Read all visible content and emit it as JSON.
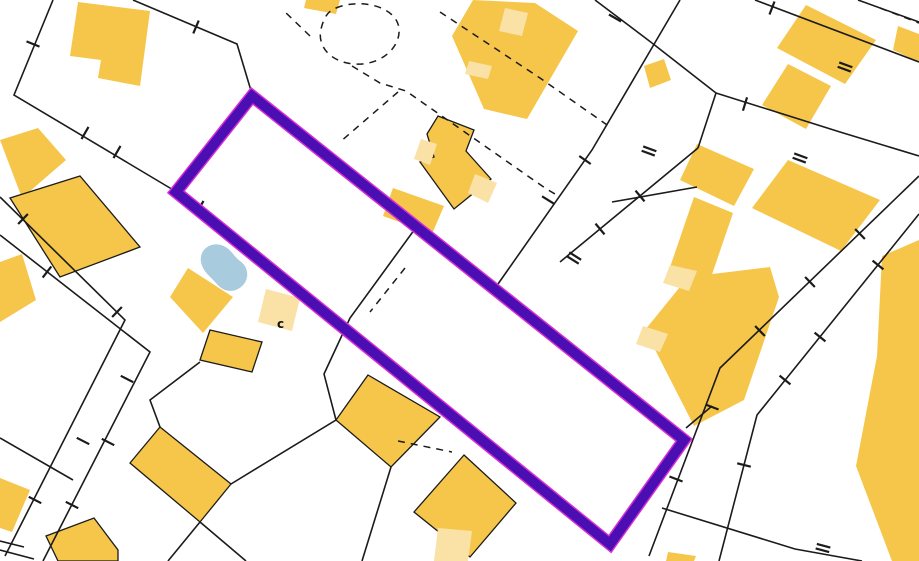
{
  "canvas": {
    "width": 919,
    "height": 561,
    "background": "#ffffff"
  },
  "palette": {
    "building": "#F6C64A",
    "building_light": "#FAE2A6",
    "water": "#A9CBDE",
    "line": "#1b1b1b",
    "highlight": "#4A0EB2",
    "highlight_fringe": "#D62FD4"
  },
  "annotation": {
    "text": "c"
  },
  "highlight_parcel": {
    "points": [
      [
        252,
        96
      ],
      [
        684,
        440
      ],
      [
        610,
        544
      ],
      [
        176,
        192
      ]
    ],
    "stroke_width": 10,
    "fringe_width": 13
  },
  "water_body": {
    "path": "M201,262 C199,250 210,242 221,245 C231,248 233,256 240,261 C249,267 250,280 241,287 C232,294 222,291 216,283 C210,276 203,272 201,262 Z"
  },
  "buildings": [
    {
      "points": [
        [
          78,
          2
        ],
        [
          150,
          11
        ],
        [
          140,
          86
        ],
        [
          98,
          78
        ],
        [
          101,
          60
        ],
        [
          70,
          56
        ]
      ],
      "fill": "building",
      "outlined": false
    },
    {
      "points": [
        [
          0,
          140
        ],
        [
          38,
          128
        ],
        [
          66,
          160
        ],
        [
          22,
          198
        ]
      ],
      "fill": "building",
      "outlined": false
    },
    {
      "points": [
        [
          10,
          198
        ],
        [
          80,
          176
        ],
        [
          140,
          247
        ],
        [
          60,
          277
        ]
      ],
      "fill": "building",
      "outlined": true
    },
    {
      "points": [
        [
          0,
          262
        ],
        [
          22,
          254
        ],
        [
          36,
          300
        ],
        [
          0,
          322
        ]
      ],
      "fill": "building",
      "outlined": false
    },
    {
      "points": [
        [
          0,
          478
        ],
        [
          30,
          490
        ],
        [
          12,
          532
        ],
        [
          0,
          528
        ]
      ],
      "fill": "building",
      "outlined": false
    },
    {
      "points": [
        [
          46,
          536
        ],
        [
          94,
          518
        ],
        [
          118,
          550
        ],
        [
          118,
          561
        ],
        [
          58,
          561
        ]
      ],
      "fill": "building",
      "outlined": true
    },
    {
      "points": [
        [
          210,
          330
        ],
        [
          262,
          342
        ],
        [
          252,
          372
        ],
        [
          200,
          360
        ]
      ],
      "fill": "building",
      "outlined": true
    },
    {
      "points": [
        [
          188,
          268
        ],
        [
          233,
          297
        ],
        [
          203,
          333
        ],
        [
          170,
          297
        ]
      ],
      "fill": "building",
      "outlined": false
    },
    {
      "points": [
        [
          266,
          289
        ],
        [
          300,
          298
        ],
        [
          292,
          331
        ],
        [
          258,
          322
        ]
      ],
      "fill": "building_light",
      "outlined": false
    },
    {
      "points": [
        [
          160,
          427
        ],
        [
          231,
          484
        ],
        [
          200,
          522
        ],
        [
          130,
          463
        ]
      ],
      "fill": "building",
      "outlined": true
    },
    {
      "points": [
        [
          368,
          375
        ],
        [
          440,
          417
        ],
        [
          391,
          467
        ],
        [
          336,
          420
        ]
      ],
      "fill": "building",
      "outlined": true
    },
    {
      "points": [
        [
          464,
          455
        ],
        [
          516,
          503
        ],
        [
          470,
          557
        ],
        [
          414,
          512
        ]
      ],
      "fill": "building",
      "outlined": true
    },
    {
      "points": [
        [
          438,
          528
        ],
        [
          472,
          531
        ],
        [
          468,
          561
        ],
        [
          434,
          561
        ]
      ],
      "fill": "building_light",
      "outlined": false
    },
    {
      "points": [
        [
          306,
          0
        ],
        [
          340,
          0
        ],
        [
          336,
          14
        ],
        [
          304,
          8
        ]
      ],
      "fill": "building",
      "outlined": false
    },
    {
      "points": [
        [
          473,
          0
        ],
        [
          535,
          3
        ],
        [
          578,
          31
        ],
        [
          527,
          119
        ],
        [
          484,
          109
        ],
        [
          452,
          36
        ]
      ],
      "fill": "building",
      "outlined": false
    },
    {
      "points": [
        [
          505,
          8
        ],
        [
          528,
          13
        ],
        [
          522,
          36
        ],
        [
          499,
          31
        ]
      ],
      "fill": "building_light",
      "outlined": false
    },
    {
      "points": [
        [
          469,
          61
        ],
        [
          492,
          66
        ],
        [
          488,
          79
        ],
        [
          465,
          74
        ]
      ],
      "fill": "building_light",
      "outlined": false
    },
    {
      "points": [
        [
          438,
          116
        ],
        [
          474,
          130
        ],
        [
          466,
          151
        ],
        [
          491,
          179
        ],
        [
          454,
          209
        ],
        [
          420,
          162
        ],
        [
          434,
          157
        ],
        [
          427,
          134
        ]
      ],
      "fill": "building",
      "outlined": true
    },
    {
      "points": [
        [
          421,
          139
        ],
        [
          437,
          144
        ],
        [
          430,
          165
        ],
        [
          414,
          159
        ]
      ],
      "fill": "building_light",
      "outlined": false
    },
    {
      "points": [
        [
          475,
          174
        ],
        [
          497,
          183
        ],
        [
          488,
          203
        ],
        [
          468,
          193
        ]
      ],
      "fill": "building_light",
      "outlined": false
    },
    {
      "points": [
        [
          393,
          188
        ],
        [
          444,
          206
        ],
        [
          432,
          234
        ],
        [
          383,
          216
        ]
      ],
      "fill": "building",
      "outlined": false
    },
    {
      "points": [
        [
          644,
          66
        ],
        [
          664,
          59
        ],
        [
          671,
          80
        ],
        [
          650,
          88
        ]
      ],
      "fill": "building",
      "outlined": false
    },
    {
      "points": [
        [
          806,
          5
        ],
        [
          876,
          40
        ],
        [
          845,
          84
        ],
        [
          777,
          48
        ]
      ],
      "fill": "building",
      "outlined": false
    },
    {
      "points": [
        [
          898,
          26
        ],
        [
          919,
          34
        ],
        [
          919,
          62
        ],
        [
          893,
          50
        ]
      ],
      "fill": "building",
      "outlined": false
    },
    {
      "points": [
        [
          788,
          64
        ],
        [
          831,
          86
        ],
        [
          806,
          129
        ],
        [
          762,
          105
        ]
      ],
      "fill": "building",
      "outlined": false
    },
    {
      "points": [
        [
          697,
          144
        ],
        [
          754,
          169
        ],
        [
          734,
          206
        ],
        [
          680,
          180
        ]
      ],
      "fill": "building",
      "outlined": false
    },
    {
      "points": [
        [
          788,
          160
        ],
        [
          880,
          200
        ],
        [
          841,
          251
        ],
        [
          752,
          208
        ]
      ],
      "fill": "building",
      "outlined": false
    },
    {
      "points": [
        [
          694,
          197
        ],
        [
          733,
          213
        ],
        [
          706,
          292
        ],
        [
          667,
          276
        ]
      ],
      "fill": "building",
      "outlined": false
    },
    {
      "points": [
        [
          688,
          277
        ],
        [
          770,
          267
        ],
        [
          779,
          297
        ],
        [
          744,
          400
        ],
        [
          694,
          426
        ],
        [
          645,
          330
        ]
      ],
      "fill": "building",
      "outlined": false
    },
    {
      "points": [
        [
          670,
          265
        ],
        [
          697,
          271
        ],
        [
          689,
          291
        ],
        [
          663,
          283
        ]
      ],
      "fill": "building_light",
      "outlined": false
    },
    {
      "points": [
        [
          643,
          326
        ],
        [
          668,
          334
        ],
        [
          660,
          352
        ],
        [
          636,
          344
        ]
      ],
      "fill": "building_light",
      "outlined": false
    },
    {
      "points": [
        [
          882,
          256
        ],
        [
          919,
          240
        ],
        [
          919,
          561
        ],
        [
          892,
          561
        ],
        [
          856,
          466
        ],
        [
          877,
          356
        ]
      ],
      "fill": "building",
      "outlined": false
    },
    {
      "points": [
        [
          668,
          552
        ],
        [
          696,
          556
        ],
        [
          694,
          561
        ],
        [
          666,
          561
        ]
      ],
      "fill": "building",
      "outlined": false
    }
  ],
  "parcel_lines": [
    {
      "points": [
        [
          53,
          0
        ],
        [
          14,
          95
        ],
        [
          175,
          191
        ]
      ]
    },
    {
      "points": [
        [
          133,
          0
        ],
        [
          237,
          44
        ],
        [
          252,
          94
        ]
      ]
    },
    {
      "points": [
        [
          0,
          197
        ],
        [
          125,
          320
        ],
        [
          5,
          556
        ]
      ]
    },
    {
      "points": [
        [
          0,
          235
        ],
        [
          150,
          352
        ],
        [
          43,
          561
        ]
      ]
    },
    {
      "points": [
        [
          0,
          438
        ],
        [
          73,
          480
        ]
      ]
    },
    {
      "points": [
        [
          0,
          550
        ],
        [
          34,
          559
        ]
      ]
    },
    {
      "points": [
        [
          0,
          541
        ],
        [
          24,
          547
        ]
      ]
    },
    {
      "points": [
        [
          160,
          427
        ],
        [
          150,
          400
        ],
        [
          200,
          362
        ]
      ]
    },
    {
      "points": [
        [
          420,
          222
        ],
        [
          350,
          318
        ],
        [
          324,
          374
        ],
        [
          336,
          420
        ],
        [
          231,
          484
        ]
      ]
    },
    {
      "points": [
        [
          200,
          522
        ],
        [
          246,
          561
        ]
      ]
    },
    {
      "points": [
        [
          200,
          522
        ],
        [
          168,
          561
        ]
      ]
    },
    {
      "points": [
        [
          391,
          467
        ],
        [
          362,
          561
        ]
      ]
    },
    {
      "points": [
        [
          680,
          0
        ],
        [
          592,
          150
        ],
        [
          498,
          284
        ]
      ]
    },
    {
      "points": [
        [
          595,
          0
        ],
        [
          652,
          43
        ]
      ]
    },
    {
      "points": [
        [
          652,
          43
        ],
        [
          716,
          93
        ]
      ]
    },
    {
      "points": [
        [
          716,
          93
        ],
        [
          698,
          148
        ]
      ]
    },
    {
      "points": [
        [
          698,
          148
        ],
        [
          560,
          262
        ]
      ]
    },
    {
      "points": [
        [
          716,
          93
        ],
        [
          840,
          132
        ],
        [
          919,
          156
        ]
      ]
    },
    {
      "points": [
        [
          755,
          0
        ],
        [
          919,
          62
        ]
      ]
    },
    {
      "points": [
        [
          858,
          0
        ],
        [
          919,
          22
        ]
      ]
    },
    {
      "points": [
        [
          919,
          176
        ],
        [
          720,
          368
        ],
        [
          649,
          556
        ]
      ]
    },
    {
      "points": [
        [
          919,
          214
        ],
        [
          757,
          415
        ],
        [
          719,
          561
        ]
      ]
    },
    {
      "points": [
        [
          686,
          428
        ],
        [
          712,
          406
        ]
      ]
    },
    {
      "points": [
        [
          662,
          508
        ],
        [
          795,
          549
        ],
        [
          862,
          561
        ]
      ]
    },
    {
      "points": [
        [
          612,
          202
        ],
        [
          697,
          187
        ]
      ]
    }
  ],
  "dashed_lines": [
    {
      "points": [
        [
          310,
          36
        ],
        [
          283,
          10
        ]
      ]
    },
    {
      "points": [
        [
          440,
          12
        ],
        [
          540,
          78
        ],
        [
          610,
          127
        ]
      ]
    },
    {
      "points": [
        [
          352,
          66
        ],
        [
          380,
          83
        ],
        [
          406,
          91
        ],
        [
          545,
          188
        ],
        [
          560,
          197
        ]
      ]
    },
    {
      "points": [
        [
          398,
          92
        ],
        [
          340,
          142
        ]
      ]
    },
    {
      "points": [
        [
          880,
          8
        ],
        [
          919,
          23
        ]
      ]
    },
    {
      "points": [
        [
          405,
          268
        ],
        [
          370,
          312
        ]
      ]
    },
    {
      "points": [
        [
          398,
          441
        ],
        [
          452,
          452
        ]
      ]
    }
  ],
  "dashed_curves": [
    {
      "d": "M336,8 C360,-2 396,6 399,28 C401,48 380,66 354,64 C330,62 317,46 321,29 C324,17 328,11 336,8 Z"
    }
  ],
  "survey_ticks": [
    [
      33,
      44,
      22,
      false
    ],
    [
      117,
      152,
      120,
      false
    ],
    [
      85,
      133,
      120,
      false
    ],
    [
      196,
      27,
      113,
      false
    ],
    [
      23,
      219,
      134,
      false
    ],
    [
      47,
      272,
      128,
      false
    ],
    [
      117,
      312,
      134,
      false
    ],
    [
      127,
      379,
      27,
      false
    ],
    [
      83,
      441,
      27,
      false
    ],
    [
      108,
      442,
      27,
      false
    ],
    [
      35,
      500,
      27,
      false
    ],
    [
      72,
      505,
      27,
      false
    ],
    [
      200,
      207,
      120,
      false
    ],
    [
      615,
      18,
      30,
      false
    ],
    [
      585,
      160,
      35,
      false
    ],
    [
      548,
      200,
      32,
      false
    ],
    [
      574,
      258,
      32,
      true
    ],
    [
      772,
      8,
      111,
      false
    ],
    [
      845,
      67,
      20,
      true
    ],
    [
      800,
      158,
      20,
      true
    ],
    [
      649,
      151,
      20,
      true
    ],
    [
      860,
      234,
      46,
      false
    ],
    [
      810,
      282,
      46,
      false
    ],
    [
      760,
      331,
      46,
      false
    ],
    [
      712,
      407,
      21,
      false
    ],
    [
      676,
      479,
      21,
      false
    ],
    [
      878,
      265,
      39,
      false
    ],
    [
      820,
      337,
      39,
      false
    ],
    [
      785,
      380,
      39,
      false
    ],
    [
      744,
      465,
      14,
      false
    ],
    [
      640,
      196,
      50,
      false
    ],
    [
      600,
      229,
      50,
      false
    ],
    [
      745,
      104,
      107,
      false
    ],
    [
      823,
      548,
      15,
      true
    ]
  ]
}
